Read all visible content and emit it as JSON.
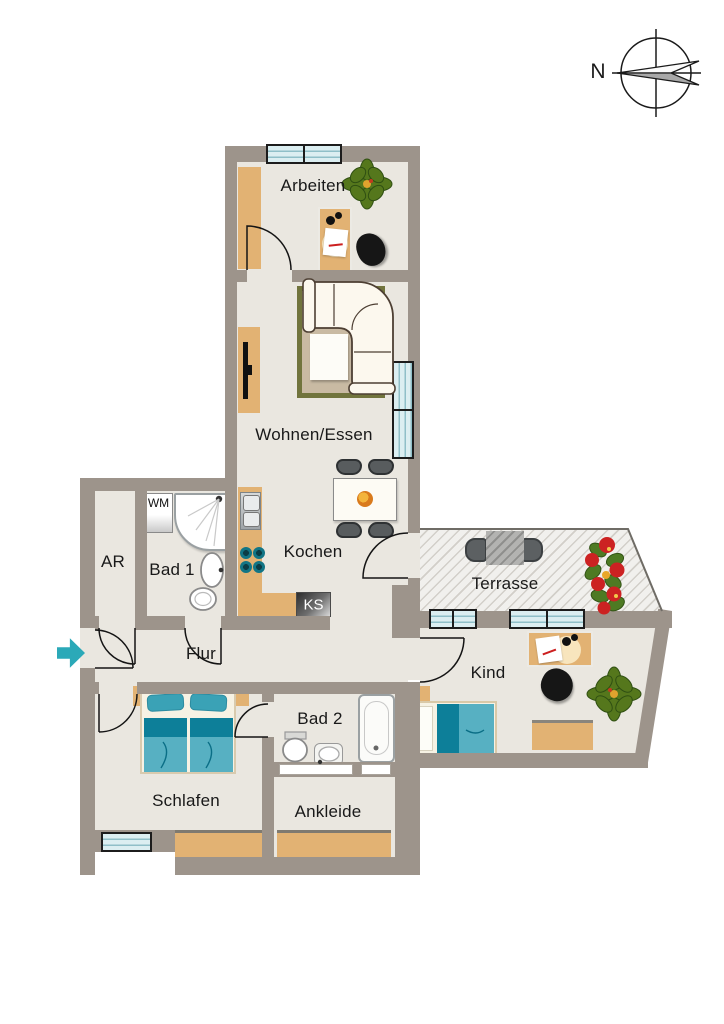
{
  "compass": {
    "label": "N"
  },
  "rooms": {
    "arbeiten": {
      "label": "Arbeiten"
    },
    "wohnen_essen": {
      "label": "Wohnen/Essen"
    },
    "kochen": {
      "label": "Kochen"
    },
    "terrasse": {
      "label": "Terrasse"
    },
    "kind": {
      "label": "Kind"
    },
    "flur": {
      "label": "Flur"
    },
    "ar": {
      "label": "AR"
    },
    "bad1": {
      "label": "Bad 1"
    },
    "bad2": {
      "label": "Bad 2"
    },
    "schlafen": {
      "label": "Schlafen"
    },
    "ankleide": {
      "label": "Ankleide"
    }
  },
  "appliances": {
    "wm": {
      "label": "WM"
    },
    "ks": {
      "label": "KS"
    }
  },
  "colors": {
    "wall": "#9d948b",
    "floor": "#eae7e0",
    "furniture_wood": "#e2b273",
    "window_glass": "#dbeef1",
    "bed_dark_teal": "#0d7f99",
    "bed_light_teal": "#57b0c2",
    "entry_arrow": "#2ba9b8",
    "plant_green": "#55771c",
    "flower_red": "#cc2222"
  }
}
